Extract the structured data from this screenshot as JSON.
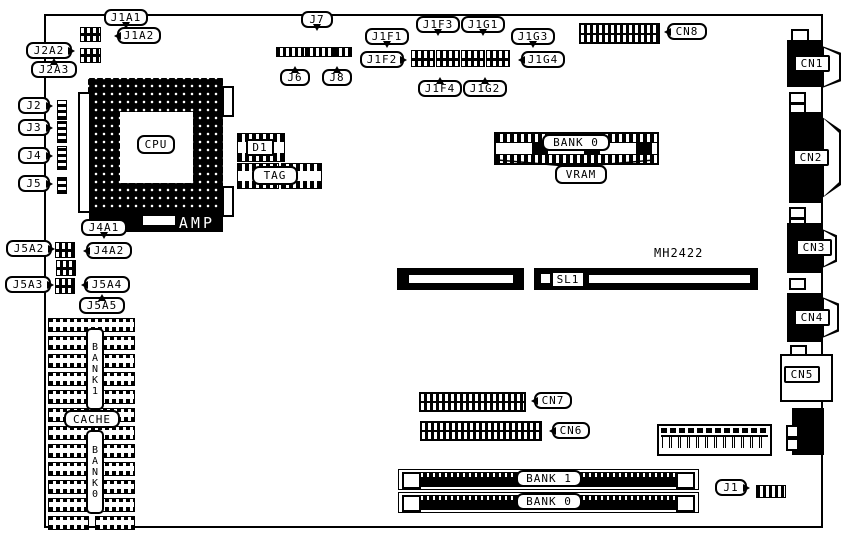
{
  "part_number": "MH2422",
  "labels": {
    "j1a1": "J1A1",
    "j1a2": "J1A2",
    "j2a2": "J2A2",
    "j2a3": "J2A3",
    "j2": "J2",
    "j3": "J3",
    "j4": "J4",
    "j5": "J5",
    "j7": "J7",
    "j6": "J6",
    "j8": "J8",
    "j1f1": "J1F1",
    "j1f2": "J1F2",
    "j1f3": "J1F3",
    "j1f4": "J1F4",
    "j1g1": "J1G1",
    "j1g2": "J1G2",
    "j1g3": "J1G3",
    "j1g4": "J1G4",
    "cn8": "CN8",
    "cn7": "CN7",
    "cn6": "CN6",
    "cn1": "CN1",
    "cn2": "CN2",
    "cn3": "CN3",
    "cn4": "CN4",
    "cn5": "CN5",
    "cpu": "CPU",
    "amp": "AMP",
    "d1": "D1",
    "tag": "TAG",
    "vram_bank": "BANK 0",
    "vram": "VRAM",
    "sl1": "SL1",
    "j4a1": "J4A1",
    "j4a2": "J4A2",
    "j5a2": "J5A2",
    "j5a3": "J5A3",
    "j5a4": "J5A4",
    "j5a5": "J5A5",
    "cache_bank1": "BANK1",
    "cache": "CACHE",
    "cache_bank0": "BANK0",
    "simm_bank1": "BANK 1",
    "simm_bank0": "BANK 0",
    "j1": "J1"
  }
}
